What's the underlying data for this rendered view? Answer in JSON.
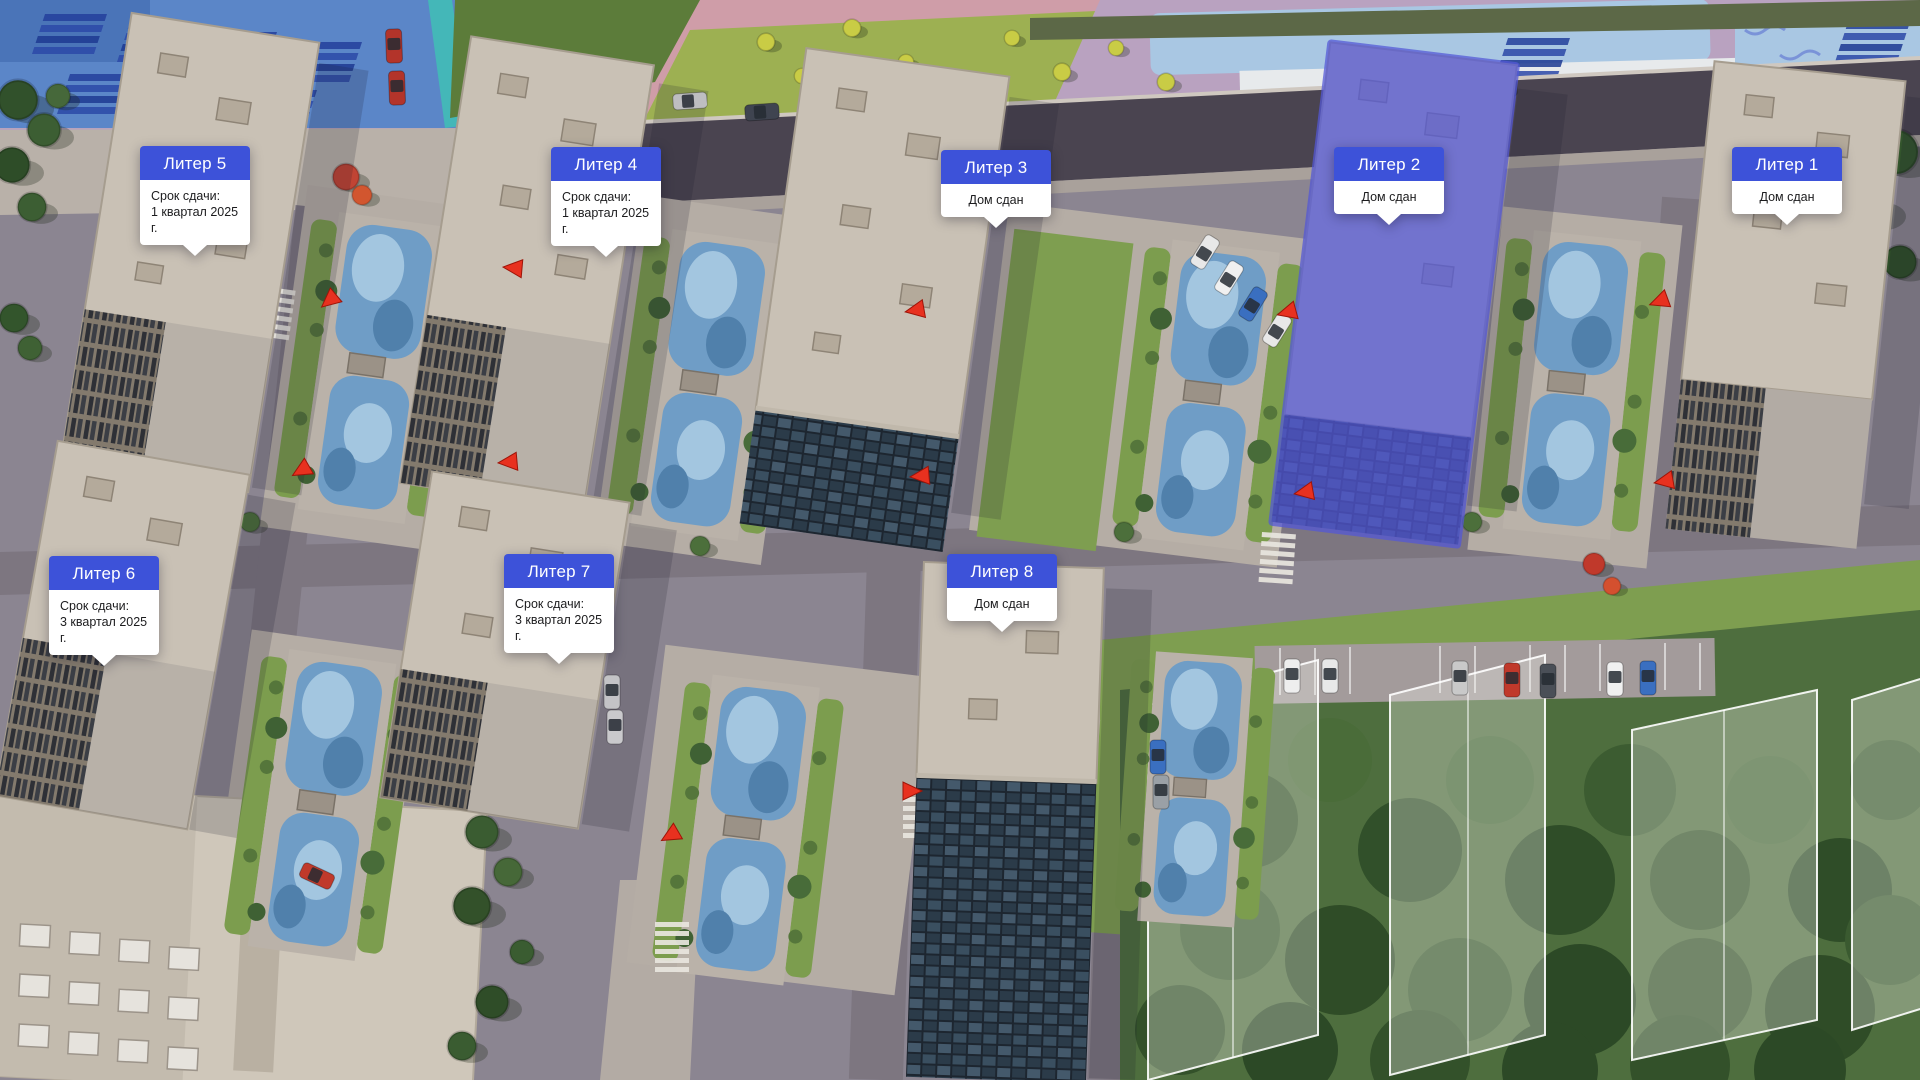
{
  "buildings": [
    {
      "id": "liter-5",
      "title": "Литер 5",
      "status_line1": "Срок сдачи:",
      "status_line2": "1 квартал 2025 г.",
      "highlighted": false
    },
    {
      "id": "liter-4",
      "title": "Литер 4",
      "status_line1": "Срок сдачи:",
      "status_line2": "1 квартал 2025 г.",
      "highlighted": false
    },
    {
      "id": "liter-3",
      "title": "Литер 3",
      "status_line1": "Дом сдан",
      "status_line2": "",
      "highlighted": false
    },
    {
      "id": "liter-2",
      "title": "Литер 2",
      "status_line1": "Дом сдан",
      "status_line2": "",
      "highlighted": true
    },
    {
      "id": "liter-1",
      "title": "Литер 1",
      "status_line1": "Дом сдан",
      "status_line2": "",
      "highlighted": false
    },
    {
      "id": "liter-6",
      "title": "Литер 6",
      "status_line1": "Срок сдачи:",
      "status_line2": "3 квартал 2025 г.",
      "highlighted": false
    },
    {
      "id": "liter-7",
      "title": "Литер 7",
      "status_line1": "Срок сдачи:",
      "status_line2": "3 квартал 2025 г.",
      "highlighted": false
    },
    {
      "id": "liter-8",
      "title": "Литер 8",
      "status_line1": "Дом сдан",
      "status_line2": "",
      "highlighted": false
    }
  ],
  "colors": {
    "label_blue": "#3D52D9",
    "building_highlight_blue": "#5458D6",
    "entrance_marker_red": "#E8311F",
    "roof_beige": "#C9C1B5",
    "playground_blue": "#6F9DC6",
    "forest_green": "#3C5C31"
  },
  "icons": {
    "entrance_marker": "red-triangle-arrow",
    "label_tail": "white-down-triangle"
  }
}
